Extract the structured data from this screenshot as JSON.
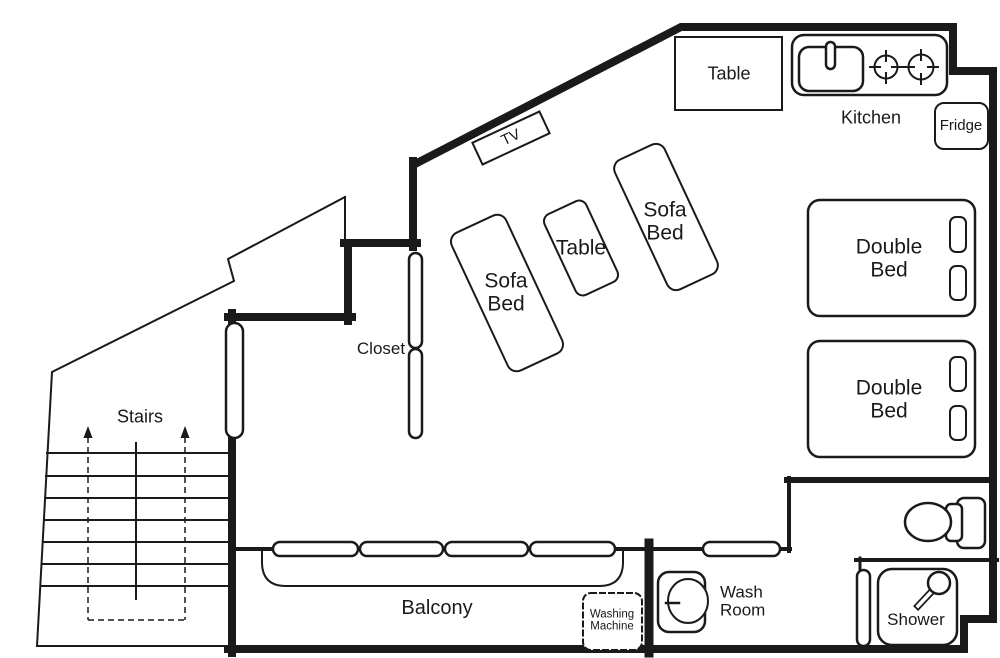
{
  "diagram": {
    "type": "floor-plan",
    "colors": {
      "line": "#1a1a1a",
      "background": "#ffffff"
    }
  },
  "labels": {
    "dining_table": "Table",
    "kitchen": "Kitchen",
    "fridge": "Fridge",
    "tv": "TV",
    "sofa_bed_left": "Sofa Bed",
    "living_table": "Table",
    "sofa_bed_right": "Sofa Bed",
    "double_bed_upper": "Double Bed",
    "double_bed_lower": "Double Bed",
    "closet": "Closet",
    "stairs": "Stairs",
    "balcony": "Balcony",
    "washing_machine": "Washing Machine",
    "wash_room": "Wash Room",
    "shower": "Shower"
  }
}
